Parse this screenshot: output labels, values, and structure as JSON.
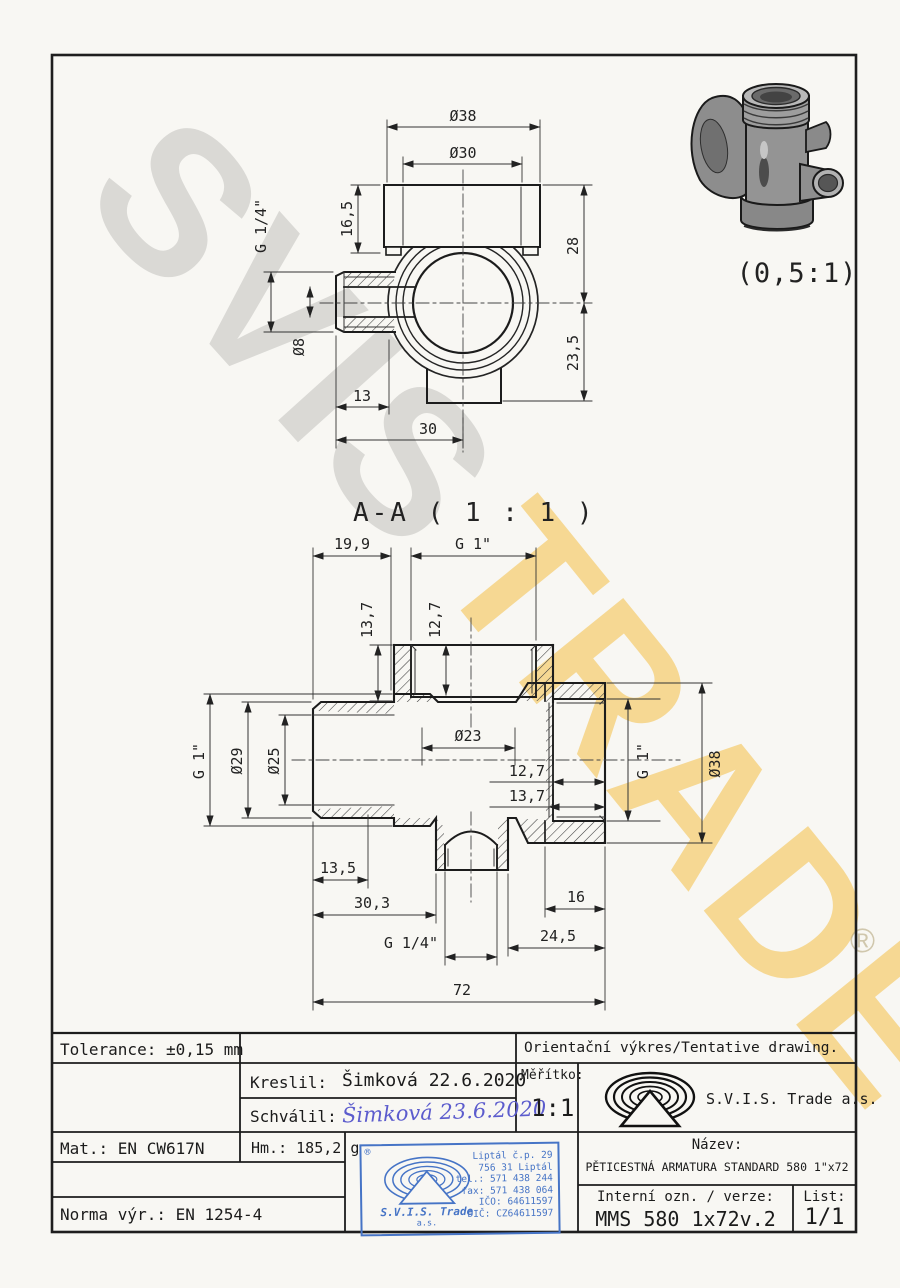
{
  "watermark": {
    "word1": "SVIS",
    "word2": "TRADE",
    "registered": "®"
  },
  "detail_view": {
    "scale_label": "(0,5:1)"
  },
  "section_label": "A-A ( 1 : 1 )",
  "top_view": {
    "dim_d38": "Ø38",
    "dim_d30": "Ø30",
    "dim_16_5": "16,5",
    "dim_28": "28",
    "dim_23_5": "23,5",
    "dim_g14": "G 1/4\"",
    "dim_d8": "Ø8",
    "dim_13": "13",
    "dim_30": "30"
  },
  "section_view": {
    "dim_19_9": "19,9",
    "dim_g1_top": "G 1\"",
    "dim_13_7_top": "13,7",
    "dim_12_7_top": "12,7",
    "dim_d23": "Ø23",
    "dim_d29": "Ø29",
    "dim_d25": "Ø25",
    "dim_g1_left": "G 1\"",
    "dim_12_7_right": "12,7",
    "dim_13_7_right": "13,7",
    "dim_g1_right": "G 1\"",
    "dim_d38_right": "Ø38",
    "dim_13_5": "13,5",
    "dim_30_3": "30,3",
    "dim_g14_bottom": "G 1/4\"",
    "dim_16": "16",
    "dim_24_5": "24,5",
    "dim_72": "72"
  },
  "title_block": {
    "tolerance": "Tolerance: ±0,15 mm",
    "kreslil_label": "Kreslil:",
    "kreslil_value": "Šimková 22.6.2020",
    "schvalil_label": "Schválil:",
    "schvalil_signature": "Šimková 23.6.2020",
    "mat": "Mat.: EN CW617N",
    "hm": "Hm.: 185,2 g",
    "norma": "Norma výr.: EN 1254-4",
    "orientacni": "Orientační výkres/Tentative drawing.",
    "meritko_label": "Měřítko:",
    "meritko_value": "1:1",
    "company": "S.V.I.S. Trade a.s.",
    "nazev_label": "Název:",
    "nazev_value": "PĚTICESTNÁ ARMATURA STANDARD 580 1\"x72",
    "interni_label": "Interní ozn. / verze:",
    "interni_value": "MMS 580 1x72v.2",
    "list_label": "List:",
    "list_value": "1/1"
  },
  "stamp": {
    "registered": "®",
    "company_line1": "S.V.I.S. Trade",
    "company_line2": "a.s.",
    "address": [
      "Liptál č.p. 29",
      "756 31 Liptál",
      "tel.: 571 438 244",
      "fax: 571 438 064",
      "IČO: 64611597",
      "DIČ: CZ64611597"
    ],
    "color": "#4674c6"
  }
}
